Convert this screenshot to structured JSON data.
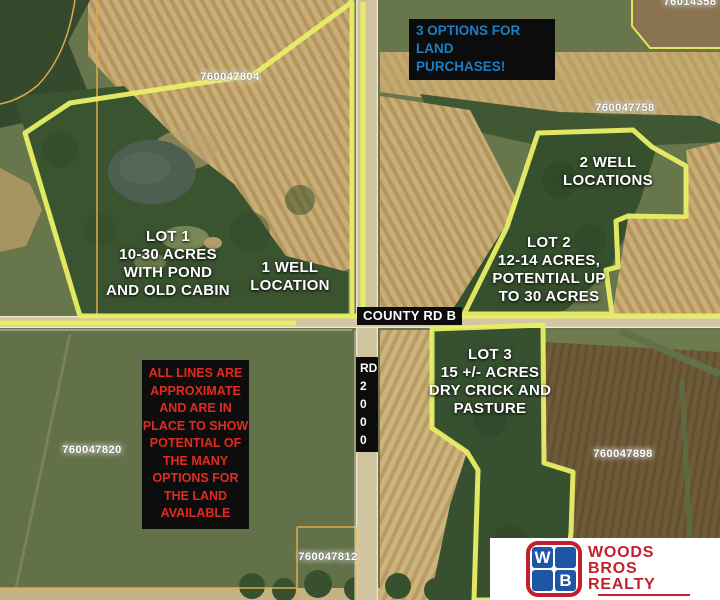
{
  "banner": {
    "text": "3 OPTIONS FOR LAND\nPURCHASES!"
  },
  "labels": {
    "lot1": "LOT 1\n10-30 ACRES\nWITH POND\nAND OLD CABIN",
    "well1": "1 WELL\nLOCATION",
    "well2": "2 WELL\nLOCATIONS",
    "lot2": "LOT 2\n12-14 ACRES,\nPOTENTIAL UP\nTO 30 ACRES",
    "lot3": "LOT 3\n15 +/- ACRES\nDRY CRICK AND\nPASTURE",
    "disclaimer": "ALL LINES ARE\nAPPROXIMATE\nAND ARE IN\nPLACE TO SHOW\nPOTENTIAL OF\nTHE MANY\nOPTIONS FOR\nTHE LAND\nAVAILABLE"
  },
  "roads": {
    "county_rd_b": "COUNTY RD B",
    "rd_2000": "RD\n2\n0\n0\n0"
  },
  "parcels": [
    {
      "id": "760047804"
    },
    {
      "id": "760047758"
    },
    {
      "id": "76014358"
    },
    {
      "id": "760047820"
    },
    {
      "id": "760047898"
    },
    {
      "id": "760047812"
    }
  ],
  "logo": {
    "tile_w": "W",
    "tile_b": "B",
    "brand": "WOODS\nBROS\nREALTY"
  },
  "colors": {
    "boundary_yellow": "#e9ef66",
    "thin_parcel_yellow": "#e6e45e",
    "parcel_line_orange": "#dcab4a",
    "banner_blue": "#1e7ec2",
    "disclaimer_red": "#e12a20",
    "label_black_bg": "#0c0c0c",
    "label_white": "#ffffff",
    "logo_red": "#c2202e",
    "logo_blue": "#1e55a5"
  }
}
